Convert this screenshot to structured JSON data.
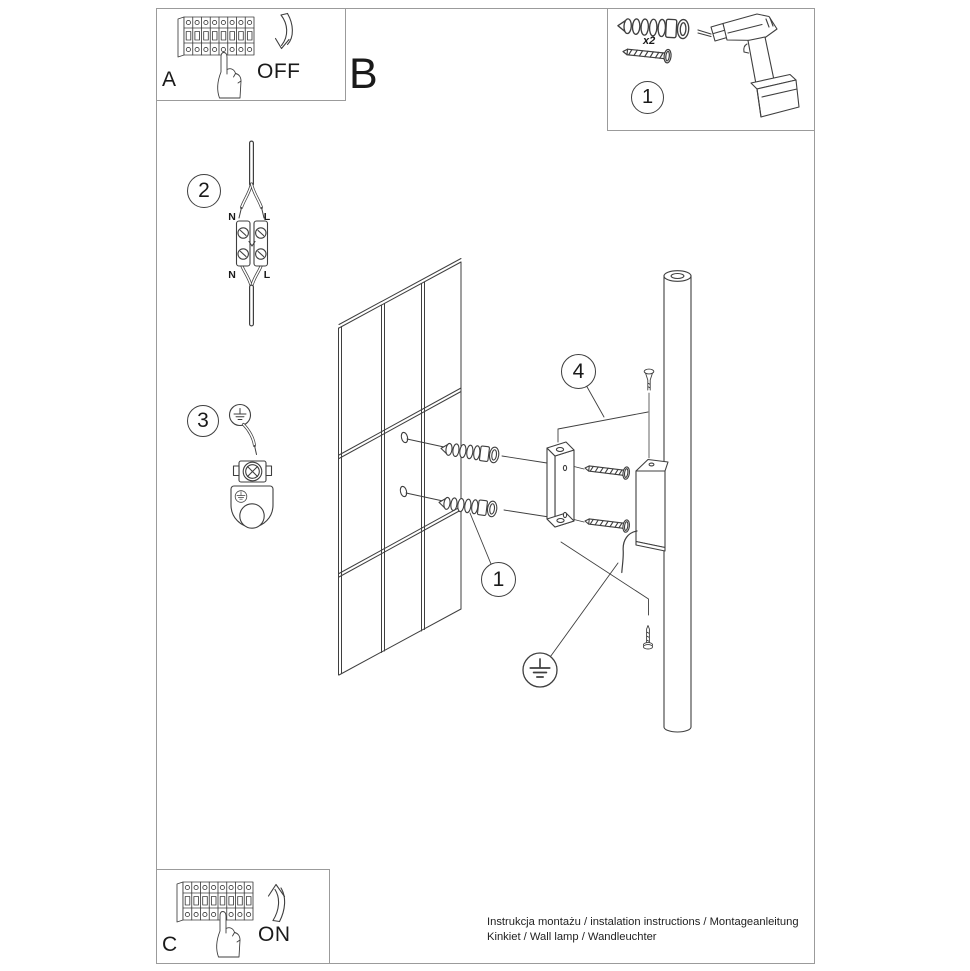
{
  "page": {
    "title_letter_b": "B",
    "footer": {
      "line1": "Instrukcja montażu / instalation instructions / Montageanleitung",
      "line2": "Kinkiet / Wall lamp / Wandleuchter"
    }
  },
  "panels": {
    "a": {
      "letter": "A",
      "state_label": "OFF"
    },
    "c": {
      "letter": "C",
      "state_label": "ON"
    },
    "parts": {
      "step_number": "1",
      "quantity": "x2"
    }
  },
  "steps": {
    "wiring": {
      "number": "2",
      "terminal_labels": [
        "N",
        "L",
        "N",
        "L"
      ]
    },
    "grounding": {
      "number": "3"
    },
    "mounting": {
      "number": "1"
    },
    "canopy": {
      "number": "4"
    }
  },
  "icons": {
    "earth-ground-icon": "⏚",
    "arrow-down-icon": "curved-arrow-down",
    "arrow-up-icon": "curved-arrow-up"
  },
  "colors": {
    "line_art": "#3f3f3f",
    "frame_border": "#9b9b9b",
    "text": "#1a1a1a"
  }
}
